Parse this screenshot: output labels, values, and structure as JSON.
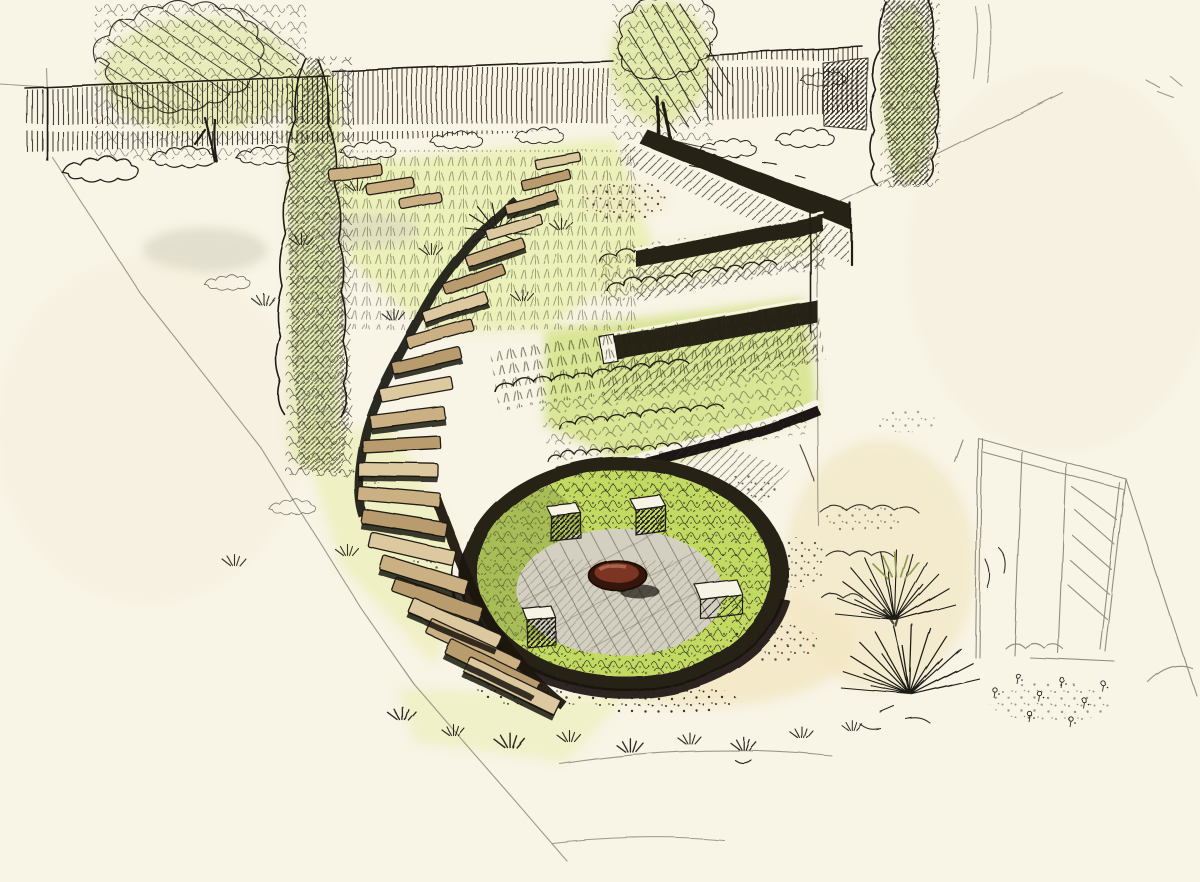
{
  "scene": {
    "aria_label": "Hand-drawn pen and ink garden design perspective sketch: winding timber steps descend terraced planted banks to a sunken circular patio with a rust-red fire bowl, cube seats, clipped hedges, cypress trees, a background fence and a lightly pencilled arbor frame at right",
    "medium": "pen, ink and green marker wash on cream paper"
  },
  "palette": {
    "paper": "#f8f4e6",
    "paper_warm": "#f3ead3",
    "ink": "#211d16",
    "pencil": "#8d8878",
    "wall_dark": "#262118",
    "white_band": "#f7f3e5",
    "wash_green_pale": "#e9efae",
    "wash_green": "#d4e387",
    "wash_green_bright": "#c3da62",
    "wash_olive": "#8a9a4c",
    "wash_gray": "#d9d5c5",
    "wash_sand": "#f2e7c3",
    "tread_light": "#dcc9a0",
    "tread_mid": "#cbb084",
    "tread_dark": "#b99c6e",
    "paving": "#d3d0c1",
    "paving_joint": "#8f8c7c",
    "bowl_dark": "#35130a",
    "bowl_body": "#7c3423",
    "bowl_light": "#a8654e"
  }
}
